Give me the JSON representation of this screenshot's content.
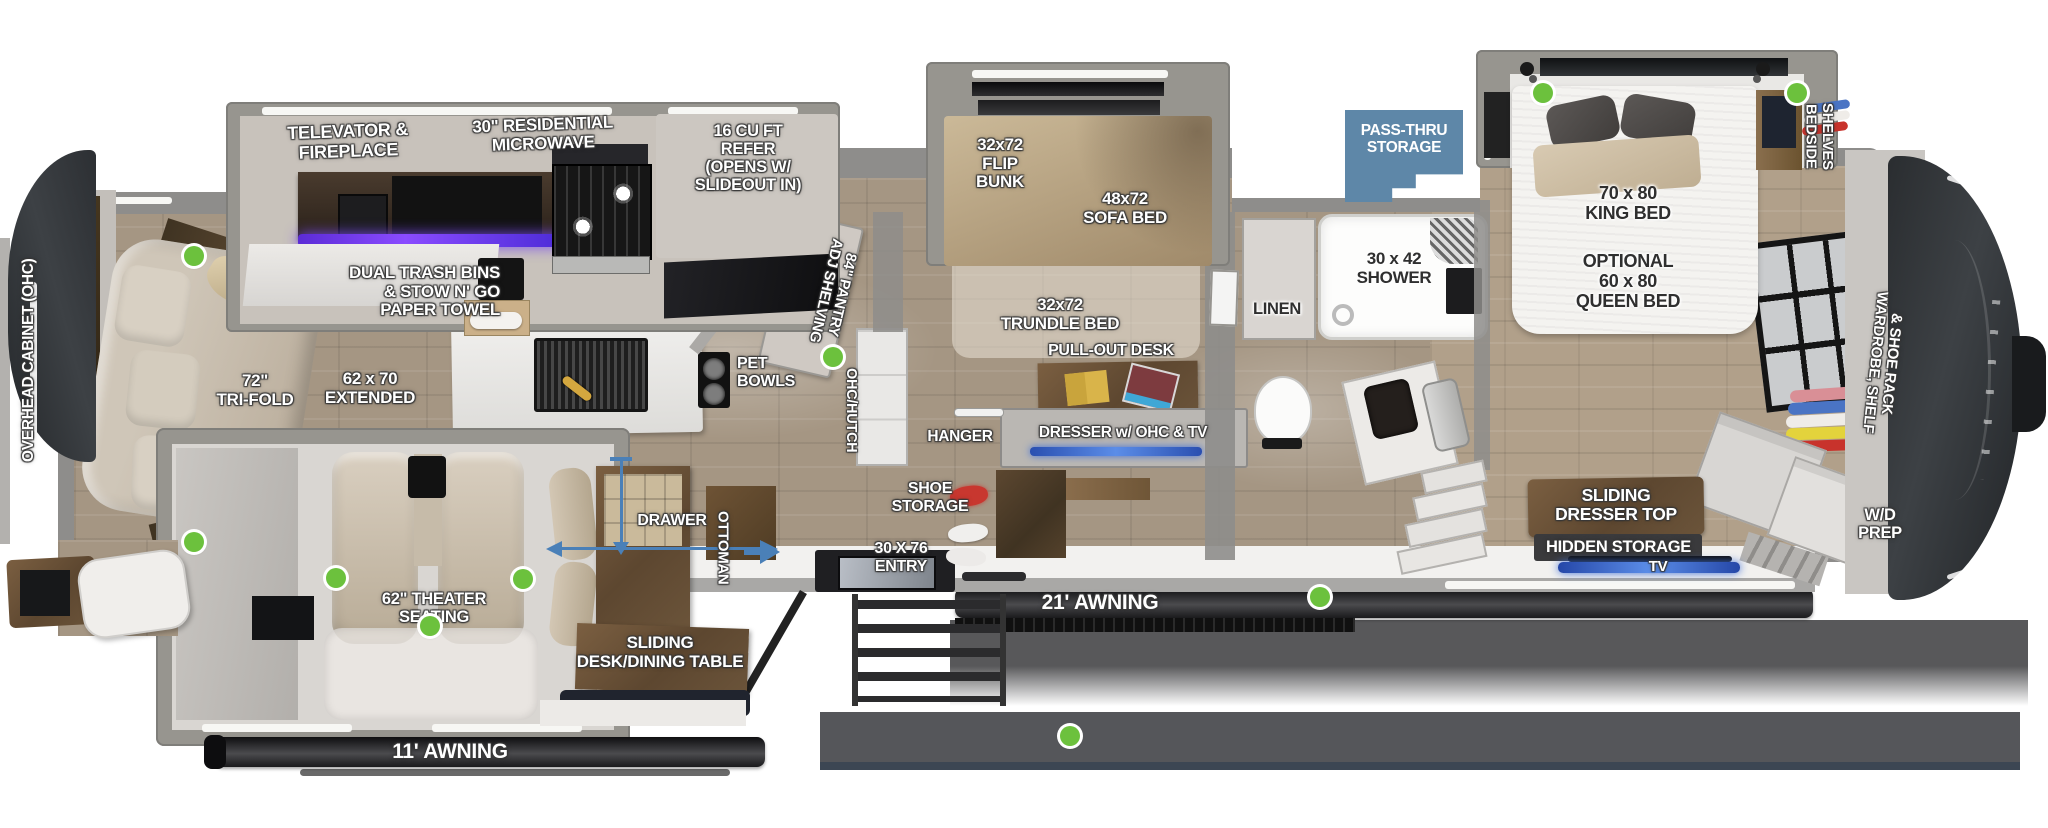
{
  "colors": {
    "marker_green": "#6cc13d",
    "pass_thru_blue": "#5e87a8",
    "arrow_blue": "#4a80b8",
    "led_purple": "#8a4bff",
    "led_blue": "#3f6fd8",
    "cap_dark": "#33363a"
  },
  "slide_kitchen": {
    "televator_fireplace": "TELEVATOR & FIREPLACE",
    "microwave": "30\" RESIDENTIAL\nMICROWAVE",
    "refer": "16 CU FT\nREFER\n(OPENS W/\nSLIDEOUT IN)"
  },
  "living": {
    "overhead_cabinet": "OVERHEAD CABINET (OHC)",
    "tri_fold": "72\"\nTRI-FOLD",
    "extended": "62 x 70\nEXTENDED",
    "trash_bins": "DUAL TRASH BINS\n& STOW N' GO\nPAPER TOWEL"
  },
  "kitchen": {
    "pet_bowls": "PET\nBOWLS",
    "pantry": "84\" PANTRY\nADJ SHELVING",
    "ohc_hutch": "OHC/HUTCH"
  },
  "slide_bunk": {
    "flip_bunk": "32x72\nFLIP\nBUNK",
    "sofa_bed": "48x72\nSOFA BED"
  },
  "bunk_room": {
    "trundle_bed": "32x72\nTRUNDLE BED",
    "pull_out_desk": "PULL-OUT DESK",
    "dresser": "DRESSER w/ OHC & TV",
    "hanger": "HANGER",
    "shoe_storage": "SHOE\nSTORAGE"
  },
  "exterior": {
    "pass_thru": "PASS-THRU\nSTORAGE",
    "entry": "30 X 76\nENTRY",
    "awning_21": "21' AWNING",
    "awning_11": "11' AWNING"
  },
  "bath": {
    "linen": "LINEN",
    "shower": "30 x 42\nSHOWER"
  },
  "bedroom": {
    "king_bed": "70 x 80\nKING BED",
    "queen_bed": "OPTIONAL\n60 x 80\nQUEEN BED",
    "bedside_shelves": "BEDSIDE\nSHELVES",
    "wardrobe": "WARDROBE, SHELF\n& SHOE RACK",
    "sliding_dresser_top": "SLIDING\nDRESSER TOP",
    "hidden_storage": "HIDDEN STORAGE",
    "tv": "TV",
    "wd_prep": "W/D\nPREP"
  },
  "dinette": {
    "theater_seating": "62\" THEATER SEATING",
    "drawer": "DRAWER",
    "ottoman": "OTTOMAN",
    "sliding_table": "SLIDING\nDESK/DINING TABLE"
  }
}
